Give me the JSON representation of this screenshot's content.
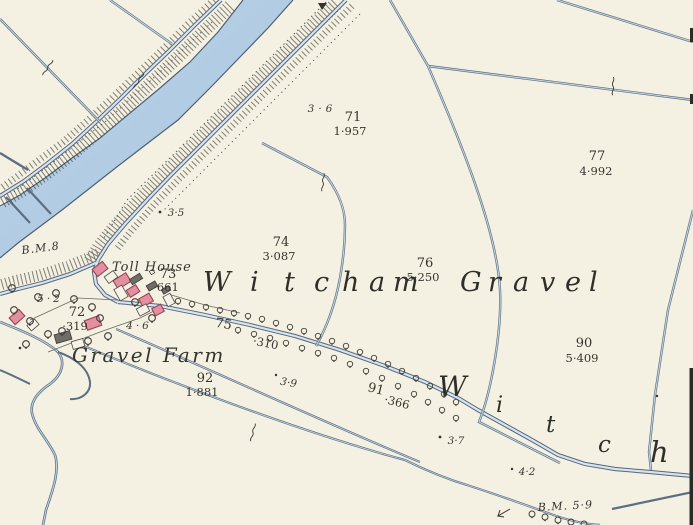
{
  "map": {
    "colors": {
      "paper": "#f4f1e3",
      "water": "#b5cee5",
      "boundary_line": "#7a90a8",
      "line_casing": "#55677c",
      "building_pink": "#e2909f",
      "building_pink_outline": "#9c4456",
      "building_gray": "#6e6e66",
      "ink": "#35352e"
    },
    "symbols": {
      "tree": "tree-symbol",
      "brace": "boundary-brace-symbol",
      "bench_mark": "bench-mark-arrow",
      "hatching": "embankment-hatching"
    },
    "place_names": {
      "toll_house": "Toll House",
      "gravel_farm": "Gravel Farm",
      "witcham_letters": [
        "W",
        "i",
        "t",
        "c",
        "h",
        "a",
        "m"
      ],
      "gravel_letters": [
        "G",
        "r",
        "a",
        "v",
        "e",
        "l"
      ],
      "witch_diagonal": [
        "W",
        "i",
        "t",
        "c",
        "h"
      ]
    },
    "parcels": [
      {
        "number": "71",
        "area": "1·957"
      },
      {
        "number": "77",
        "area": "4·992"
      },
      {
        "number": "74",
        "area": "3·087"
      },
      {
        "number": "73",
        "area": "·661"
      },
      {
        "number": "76",
        "area": "5·250"
      },
      {
        "number": "75",
        "area": "·310"
      },
      {
        "number": "72",
        "area": "·319"
      },
      {
        "number": "90",
        "area": "5·409"
      },
      {
        "number": "92",
        "area": "1·881"
      },
      {
        "number": "91",
        "area": "·366"
      }
    ],
    "spot_heights": [
      {
        "value": "3·6"
      },
      {
        "value": "3·5"
      },
      {
        "value": "4·6"
      },
      {
        "value": "5·2"
      },
      {
        "value": "3·9"
      },
      {
        "value": "3·7"
      },
      {
        "value": "4·2"
      }
    ],
    "benchmarks": [
      {
        "label": "B.M.8"
      },
      {
        "label": "B.M. 5·9"
      }
    ]
  }
}
